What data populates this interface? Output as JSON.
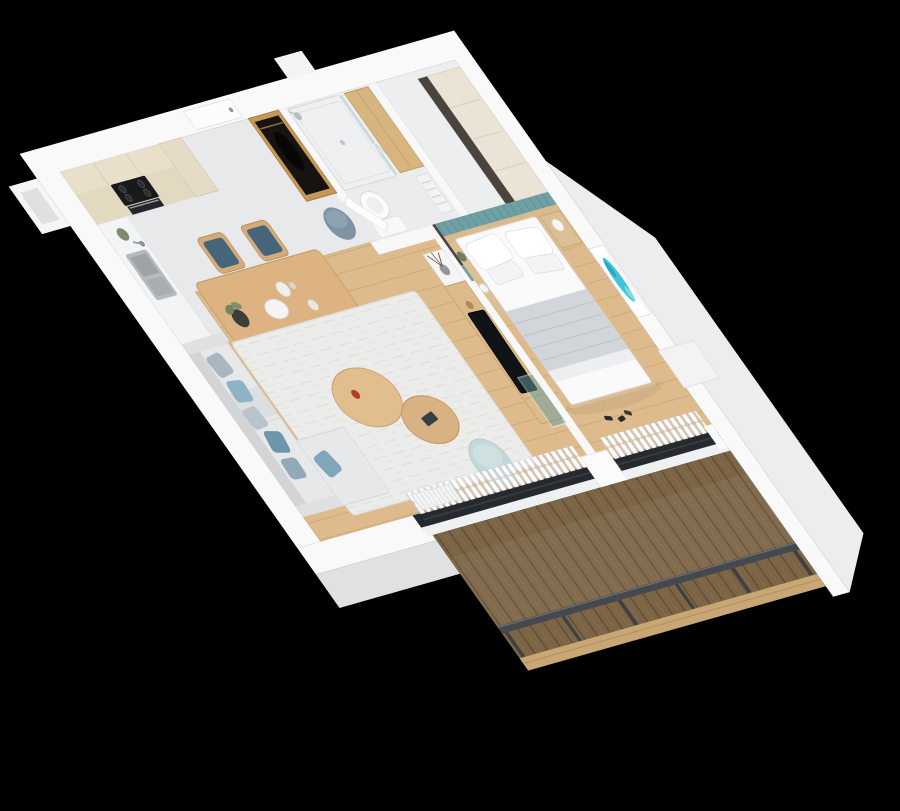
{
  "scene": {
    "type": "3d-apartment-floor-plan-render",
    "view": "isometric-top-down-cutaway",
    "background": "#000000",
    "rooms": [
      {
        "name": "kitchen",
        "items": [
          "upper-cabinets",
          "base-cabinets",
          "tall-cabinet",
          "cooktop",
          "oven",
          "countertop",
          "sink",
          "faucet",
          "counter-plant"
        ]
      },
      {
        "name": "dining-area",
        "items": [
          "dining-table",
          "dining-chairs",
          "plant-pot",
          "plates",
          "bowls"
        ]
      },
      {
        "name": "hallway",
        "items": [
          "entry-door",
          "open-wardrobe",
          "hanging-coat",
          "round-pouf"
        ]
      },
      {
        "name": "bathroom",
        "items": [
          "walk-in-shower",
          "glass-screen",
          "shower-head",
          "toilet",
          "oak-storage-cabinet",
          "towel-radiator",
          "bathroom-door"
        ]
      },
      {
        "name": "bedroom",
        "items": [
          "double-bed",
          "pillows",
          "gray-blanket",
          "teal-headboard-wall",
          "wood-ledge-shelf",
          "wardrobe-dark-panel",
          "nightstand",
          "mushroom-lamp",
          "bedside-plant",
          "wall-art",
          "curtains",
          "window-ledge"
        ]
      },
      {
        "name": "living-room",
        "items": [
          "corner-sofa",
          "blue-cushions",
          "area-rug",
          "coffee-tables",
          "teal-pouf",
          "tv-console",
          "tv",
          "floating-shelf",
          "vase",
          "teal-glass-panel",
          "radiator",
          "curtains"
        ]
      },
      {
        "name": "balcony",
        "items": [
          "wood-decking",
          "metal-railing",
          "railing-posts",
          "edge-boards"
        ]
      }
    ],
    "counts": {
      "dining_chairs": 5,
      "sofa_cushions": 6,
      "bed_pillows": 4,
      "railing_posts": 6
    }
  },
  "palette": {
    "background": "#000000",
    "wall": "#f9f9f9",
    "wall_face": "#ededef",
    "floor_wood": "#ddbb8d",
    "floor_tile": "#e7e9ea",
    "deck_wood": "#7c6546",
    "deck_edge": "#c9a775",
    "railing": "#45494e",
    "accent_teal": "#6fa0a4",
    "art_teal": "#3fc4d8",
    "cabinet_cream": "#eadfca",
    "wood_furniture": "#dcb381",
    "sofa": "#e7e8ea",
    "rug": "#ececeb",
    "pouf_teal": "#c3d8da",
    "pouf_slate": "#7e93a3",
    "wardrobe_oak": "#c79757",
    "wardrobe_dark": "#4a433e",
    "tv_screen": "#101316",
    "window_frame": "#26292d",
    "bedding": "#fafafa",
    "blanket": "#d2d6da"
  }
}
